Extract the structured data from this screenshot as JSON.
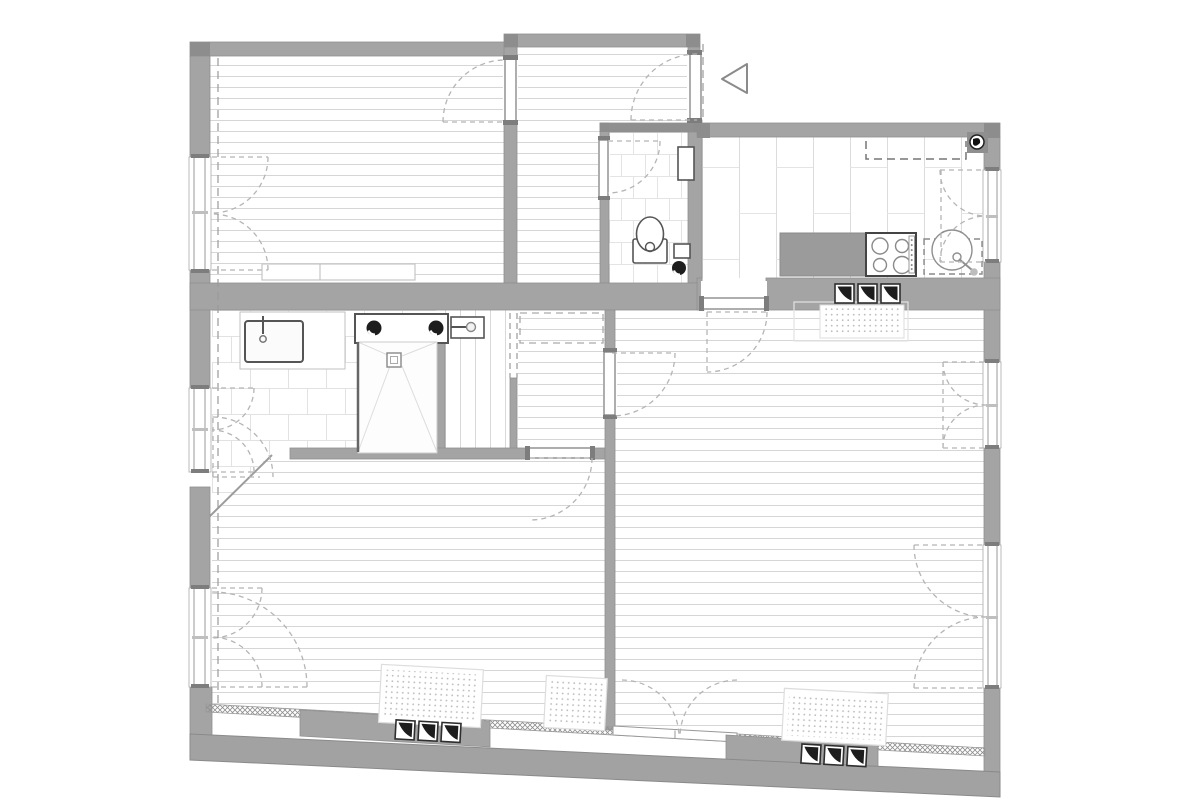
{
  "document": {
    "kind": "architectural floor plan",
    "visible_text": "",
    "orientation_marker": "hollow triangle pointing left near entrance"
  },
  "colors": {
    "background": "#ffffff",
    "wall": "#a4a4a4",
    "wall_dark": "#8d8d8d",
    "wall_edge": "#8f8f8f",
    "band_outer": "#a2a2a2",
    "floor_line": "#d6d6d6",
    "tile_line": "#e2e2e2",
    "fixture_stroke": "#555555",
    "fixture_light": "#bbbbbb",
    "dash": "#b5b5b5",
    "ref_dash": "#9a9a9a",
    "vent_black": "#1d1d1d",
    "marker_stroke": "#8a8a8a"
  },
  "rooms": [
    {
      "id": "room-top-left",
      "label": "room with horizontal plank floor, three-window left wall"
    },
    {
      "id": "entry-hall",
      "label": "entry hall with entrance door swing"
    },
    {
      "id": "wc",
      "label": "WC with toilet, small tiles"
    },
    {
      "id": "kitchen",
      "label": "kitchen with cooktop, round sink, vertical plank floor"
    },
    {
      "id": "bathroom",
      "label": "bathroom with basin, double-outlet unit, walk-in shower, large tiles"
    },
    {
      "id": "corridor",
      "label": "corridor / stair treads strip"
    },
    {
      "id": "closet",
      "label": "closet room with dashed wardrobe"
    },
    {
      "id": "living-room",
      "label": "large living room right side"
    },
    {
      "id": "room-bottom-left",
      "label": "room bottom left with diagonal corner"
    }
  ],
  "fixtures": {
    "toilet": "toilet with cistern and flush dot",
    "bath_sink": "square washbasin with faucet",
    "double_outlet": "rectangular unit with two black water outlets",
    "hand_basin": "small hand basin with side tap",
    "shower": "walk-in shower with corner diagonals and center drain",
    "cooktop": "4-burner cooktop with control strip",
    "kitchen_sink": "round sink with tap, dashed counter outline",
    "counter_block": "solid gray kitchen counter block",
    "wall_cabinet": "dashed overhead cabinet outline",
    "corner_unit": "dark corner block with pipe symbol",
    "wc_cabinet": "tall narrow cabinet on WC wall",
    "low_cabinet": "low cabinet strip in top-left room"
  },
  "radiators": {
    "count": 5,
    "style": "dotted fill rectangles"
  },
  "vents": {
    "groups": 3,
    "per_group": 3,
    "style": "square grille with black curved triangle"
  },
  "windows": {
    "left_wall": 3,
    "right_wall": 3,
    "style": "double casement with dashed quarter-circle swings"
  },
  "doors": {
    "count": 9,
    "style": "white leaf with dashed quarter-circle swing"
  }
}
